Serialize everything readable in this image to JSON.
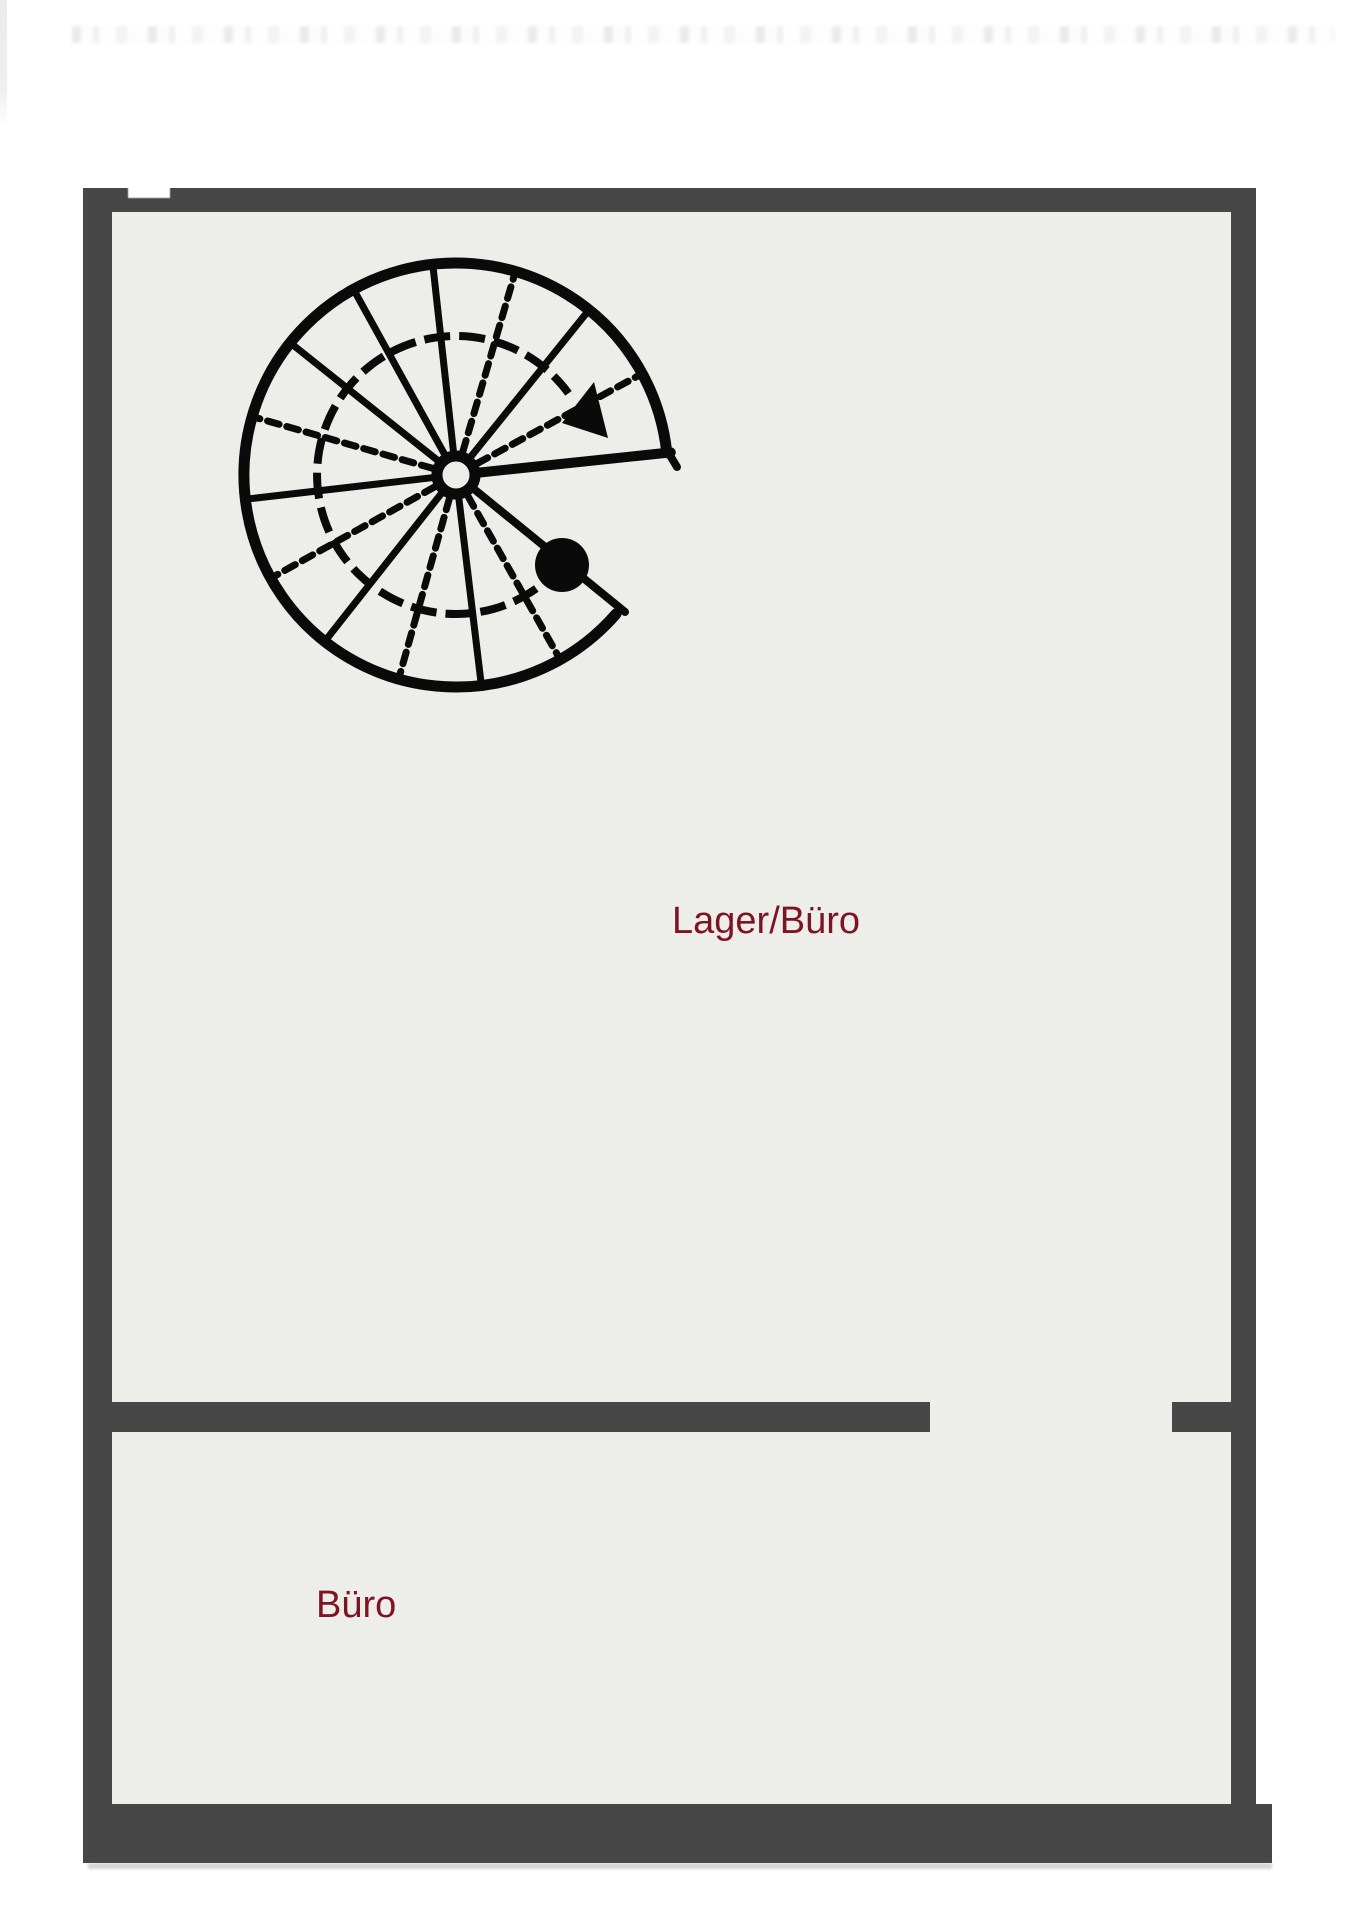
{
  "page": {
    "background": "#ffffff",
    "kind": "scanned floor plan"
  },
  "floor_plan": {
    "colors": {
      "wall": "#474747",
      "floor": "#edeee9",
      "stair_ink": "#0a0a0a",
      "room_label": "#7d1423"
    },
    "rooms": [
      {
        "key": "lager_buero",
        "label": "Lager/Büro"
      },
      {
        "key": "buero",
        "label": "Büro"
      }
    ],
    "openings": [
      {
        "key": "door_gap",
        "location": "divider wall between rooms"
      }
    ],
    "staircase": {
      "symbol": "spiral-staircase",
      "tread_sectors": 14,
      "has_direction_arrow": true,
      "has_start_dot": true
    }
  }
}
